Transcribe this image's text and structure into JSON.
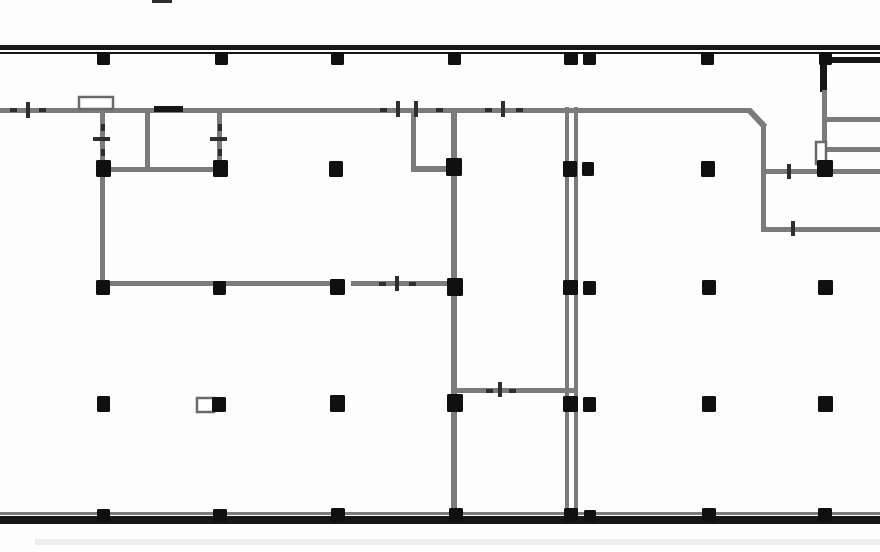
{
  "meta": {
    "title": "Architectural floor plan drawing",
    "canvas": {
      "width": 880,
      "height": 552
    },
    "visible_text": []
  },
  "colors": {
    "background": "#fdfdfd",
    "exterior_wall": "#161616",
    "interior_wall": "#7b7b7b",
    "column": "#101010",
    "tick": "#2e2e2e",
    "ghost": "#ededed",
    "fixture_border": "#6a6a6a",
    "fixture_fill": "#ffffff",
    "gap_fill": "#fdfdfd"
  },
  "plan": {
    "walls": [
      {
        "name": "top-exterior-wall-outer",
        "x": 0,
        "y": 45,
        "w": 880,
        "h": 5,
        "color": "exterior_wall"
      },
      {
        "name": "top-exterior-wall-inner",
        "x": 0,
        "y": 52,
        "w": 880,
        "h": 2,
        "color": "exterior_wall"
      },
      {
        "name": "bottom-wall-top-line",
        "x": 0,
        "y": 512,
        "w": 880,
        "h": 3,
        "color": "interior_wall"
      },
      {
        "name": "bottom-exterior-wall",
        "x": 0,
        "y": 516,
        "w": 880,
        "h": 8,
        "color": "exterior_wall"
      },
      {
        "name": "below-wall-ghost-line",
        "x": 35,
        "y": 539,
        "w": 845,
        "h": 6,
        "color": "ghost"
      },
      {
        "name": "top-edge-dash",
        "x": 152,
        "y": 0,
        "w": 20,
        "h": 3,
        "color": "tick"
      },
      {
        "name": "main-corridor-wall",
        "x": 0,
        "y": 108,
        "w": 751,
        "h": 5,
        "color": "interior_wall"
      },
      {
        "name": "right-wing-vertical-wall",
        "x": 761,
        "y": 125,
        "w": 5,
        "h": 107,
        "color": "interior_wall"
      },
      {
        "name": "right-wing-bottom-wall",
        "x": 761,
        "y": 227,
        "w": 119,
        "h": 5,
        "color": "interior_wall"
      },
      {
        "name": "right-room-horizontal-1",
        "x": 766,
        "y": 169,
        "w": 114,
        "h": 5,
        "color": "interior_wall"
      },
      {
        "name": "right-room-horizontal-2",
        "x": 823,
        "y": 147,
        "w": 57,
        "h": 5,
        "color": "interior_wall"
      },
      {
        "name": "right-room-horizontal-3",
        "x": 827,
        "y": 117,
        "w": 53,
        "h": 5,
        "color": "interior_wall"
      },
      {
        "name": "right-room-divider-black",
        "x": 831,
        "y": 57,
        "w": 49,
        "h": 6,
        "color": "exterior_wall"
      },
      {
        "name": "right-shaft-vertical-upper",
        "x": 820,
        "y": 52,
        "w": 7,
        "h": 40,
        "color": "exterior_wall"
      },
      {
        "name": "right-shaft-vertical-lower",
        "x": 822,
        "y": 90,
        "w": 5,
        "h": 78,
        "color": "interior_wall"
      },
      {
        "name": "room-a-left-wall",
        "x": 100,
        "y": 111,
        "w": 5,
        "h": 172,
        "color": "interior_wall"
      },
      {
        "name": "room-a-middle-wall",
        "x": 145,
        "y": 111,
        "w": 5,
        "h": 60,
        "color": "interior_wall"
      },
      {
        "name": "room-a-right-wall",
        "x": 217,
        "y": 111,
        "w": 5,
        "h": 55,
        "color": "interior_wall"
      },
      {
        "name": "room-a-bottom-wall",
        "x": 100,
        "y": 167,
        "w": 123,
        "h": 5,
        "color": "interior_wall"
      },
      {
        "name": "room-a-door-lintel",
        "x": 154,
        "y": 106,
        "w": 29,
        "h": 6,
        "color": "exterior_wall"
      },
      {
        "name": "room-b-left-wall",
        "x": 411,
        "y": 111,
        "w": 5,
        "h": 58,
        "color": "interior_wall"
      },
      {
        "name": "room-b-bottom-wall",
        "x": 411,
        "y": 166,
        "w": 46,
        "h": 6,
        "color": "interior_wall"
      },
      {
        "name": "central-spine-wall",
        "x": 451,
        "y": 110,
        "w": 6,
        "h": 408,
        "color": "interior_wall"
      },
      {
        "name": "shaft-wall-left-line",
        "x": 565,
        "y": 107,
        "w": 4,
        "h": 410,
        "color": "interior_wall"
      },
      {
        "name": "shaft-wall-right-line",
        "x": 574,
        "y": 107,
        "w": 4,
        "h": 410,
        "color": "interior_wall"
      },
      {
        "name": "mid-level-horizontal-wall",
        "x": 100,
        "y": 281,
        "w": 353,
        "h": 5,
        "color": "interior_wall"
      },
      {
        "name": "lower-room-horizontal-wall",
        "x": 452,
        "y": 388,
        "w": 126,
        "h": 5,
        "color": "interior_wall"
      }
    ],
    "diagonals": [
      {
        "name": "corridor-chamfer-wall",
        "x1": 749,
        "y1": 110,
        "x2": 765,
        "y2": 127,
        "width": 6,
        "color": "interior_wall"
      }
    ],
    "white_gaps": [
      {
        "name": "door-gap-mid-wall",
        "x": 342,
        "y": 280,
        "w": 9,
        "h": 7
      }
    ],
    "fixtures": [
      {
        "name": "door-recess-box",
        "x": 79,
        "y": 97,
        "w": 34,
        "h": 12
      },
      {
        "name": "door-jamb-right",
        "x": 816,
        "y": 142,
        "w": 10,
        "h": 22
      },
      {
        "name": "equipment-box",
        "x": 197,
        "y": 398,
        "w": 17,
        "h": 14
      }
    ],
    "door_ticks": [
      {
        "name": "tick-tall",
        "x": 26,
        "y": 102,
        "w": 4,
        "h": 16
      },
      {
        "name": "tick-dash",
        "x": 10,
        "y": 108,
        "w": 7,
        "h": 4
      },
      {
        "name": "tick-dash",
        "x": 39,
        "y": 108,
        "w": 7,
        "h": 4
      },
      {
        "name": "tick-dash",
        "x": 380,
        "y": 108,
        "w": 7,
        "h": 4
      },
      {
        "name": "tick-tall",
        "x": 396,
        "y": 101,
        "w": 4,
        "h": 16
      },
      {
        "name": "tick-tall",
        "x": 414,
        "y": 101,
        "w": 4,
        "h": 16
      },
      {
        "name": "tick-dash",
        "x": 436,
        "y": 108,
        "w": 7,
        "h": 4
      },
      {
        "name": "tick-dash",
        "x": 485,
        "y": 108,
        "w": 7,
        "h": 4
      },
      {
        "name": "tick-tall",
        "x": 501,
        "y": 101,
        "w": 4,
        "h": 16
      },
      {
        "name": "tick-dash",
        "x": 516,
        "y": 108,
        "w": 7,
        "h": 4
      },
      {
        "name": "tick-wide",
        "x": 93,
        "y": 137,
        "w": 17,
        "h": 4
      },
      {
        "name": "tick-dot",
        "x": 101,
        "y": 124,
        "w": 4,
        "h": 7
      },
      {
        "name": "tick-dot",
        "x": 101,
        "y": 149,
        "w": 4,
        "h": 7
      },
      {
        "name": "tick-wide",
        "x": 210,
        "y": 137,
        "w": 17,
        "h": 4
      },
      {
        "name": "tick-dot",
        "x": 218,
        "y": 124,
        "w": 4,
        "h": 7
      },
      {
        "name": "tick-dot",
        "x": 218,
        "y": 149,
        "w": 4,
        "h": 7
      },
      {
        "name": "tick-dash",
        "x": 379,
        "y": 282,
        "w": 7,
        "h": 4
      },
      {
        "name": "tick-tall",
        "x": 395,
        "y": 276,
        "w": 4,
        "h": 15
      },
      {
        "name": "tick-dash",
        "x": 409,
        "y": 282,
        "w": 7,
        "h": 4
      },
      {
        "name": "tick-dash",
        "x": 486,
        "y": 389,
        "w": 7,
        "h": 4
      },
      {
        "name": "tick-tall",
        "x": 498,
        "y": 382,
        "w": 4,
        "h": 15
      },
      {
        "name": "tick-dash",
        "x": 509,
        "y": 389,
        "w": 7,
        "h": 4
      },
      {
        "name": "tick-tall",
        "x": 787,
        "y": 164,
        "w": 4,
        "h": 15
      },
      {
        "name": "tick-tall",
        "x": 791,
        "y": 221,
        "w": 4,
        "h": 15
      }
    ],
    "columns": [
      {
        "x": 97,
        "y": 52,
        "w": 13,
        "h": 13
      },
      {
        "x": 215,
        "y": 52,
        "w": 13,
        "h": 13
      },
      {
        "x": 331,
        "y": 52,
        "w": 13,
        "h": 13
      },
      {
        "x": 448,
        "y": 52,
        "w": 13,
        "h": 13
      },
      {
        "x": 564,
        "y": 52,
        "w": 14,
        "h": 13
      },
      {
        "x": 583,
        "y": 52,
        "w": 13,
        "h": 13
      },
      {
        "x": 701,
        "y": 52,
        "w": 13,
        "h": 13
      },
      {
        "x": 819,
        "y": 52,
        "w": 13,
        "h": 13
      },
      {
        "x": 96,
        "y": 160,
        "w": 15,
        "h": 17
      },
      {
        "x": 213,
        "y": 160,
        "w": 15,
        "h": 17
      },
      {
        "x": 329,
        "y": 161,
        "w": 14,
        "h": 16
      },
      {
        "x": 446,
        "y": 158,
        "w": 16,
        "h": 18
      },
      {
        "x": 563,
        "y": 161,
        "w": 14,
        "h": 16
      },
      {
        "x": 582,
        "y": 162,
        "w": 12,
        "h": 14
      },
      {
        "x": 701,
        "y": 161,
        "w": 14,
        "h": 16
      },
      {
        "x": 817,
        "y": 160,
        "w": 16,
        "h": 17
      },
      {
        "x": 96,
        "y": 280,
        "w": 14,
        "h": 15
      },
      {
        "x": 213,
        "y": 281,
        "w": 13,
        "h": 14
      },
      {
        "x": 330,
        "y": 279,
        "w": 15,
        "h": 16
      },
      {
        "x": 447,
        "y": 278,
        "w": 16,
        "h": 18
      },
      {
        "x": 563,
        "y": 280,
        "w": 15,
        "h": 15
      },
      {
        "x": 583,
        "y": 281,
        "w": 13,
        "h": 14
      },
      {
        "x": 702,
        "y": 280,
        "w": 14,
        "h": 15
      },
      {
        "x": 818,
        "y": 280,
        "w": 15,
        "h": 15
      },
      {
        "x": 97,
        "y": 396,
        "w": 13,
        "h": 16
      },
      {
        "x": 212,
        "y": 397,
        "w": 14,
        "h": 15
      },
      {
        "x": 330,
        "y": 395,
        "w": 15,
        "h": 17
      },
      {
        "x": 447,
        "y": 394,
        "w": 16,
        "h": 18
      },
      {
        "x": 563,
        "y": 396,
        "w": 15,
        "h": 16
      },
      {
        "x": 583,
        "y": 397,
        "w": 13,
        "h": 15
      },
      {
        "x": 702,
        "y": 396,
        "w": 14,
        "h": 16
      },
      {
        "x": 818,
        "y": 396,
        "w": 15,
        "h": 16
      },
      {
        "x": 97,
        "y": 509,
        "w": 13,
        "h": 13
      },
      {
        "x": 213,
        "y": 509,
        "w": 14,
        "h": 13
      },
      {
        "x": 331,
        "y": 508,
        "w": 14,
        "h": 14
      },
      {
        "x": 449,
        "y": 508,
        "w": 14,
        "h": 14
      },
      {
        "x": 564,
        "y": 508,
        "w": 14,
        "h": 14
      },
      {
        "x": 584,
        "y": 510,
        "w": 12,
        "h": 12
      },
      {
        "x": 702,
        "y": 508,
        "w": 14,
        "h": 14
      },
      {
        "x": 818,
        "y": 508,
        "w": 14,
        "h": 14
      }
    ]
  }
}
